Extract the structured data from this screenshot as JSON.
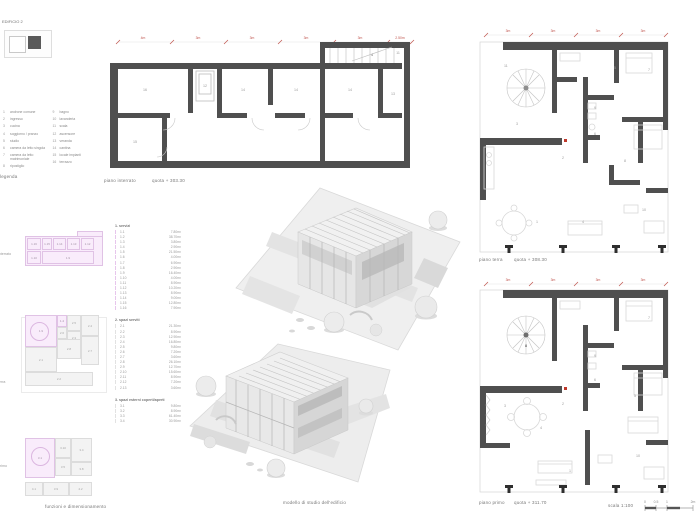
{
  "header": {
    "project_label": "EDIFICIO 2"
  },
  "legend": {
    "title": "legenda",
    "columns": [
      [
        {
          "n": "1",
          "label": "androne comune"
        },
        {
          "n": "2",
          "label": "ingresso"
        },
        {
          "n": "3",
          "label": "cucina"
        },
        {
          "n": "4",
          "label": "soggiorno / pranzo"
        },
        {
          "n": "5",
          "label": "studio"
        },
        {
          "n": "6",
          "label": "camera da letto singola"
        },
        {
          "n": "7",
          "label": "camera da letto matrimoniale"
        },
        {
          "n": "8",
          "label": "ripostiglio"
        }
      ],
      [
        {
          "n": "9",
          "label": "bagno"
        },
        {
          "n": "10",
          "label": "lavanderia"
        },
        {
          "n": "11",
          "label": "scala"
        },
        {
          "n": "12",
          "label": "ascensore"
        },
        {
          "n": "13",
          "label": "veranda"
        },
        {
          "n": "14",
          "label": "cantina"
        },
        {
          "n": "15",
          "label": "locale impianti"
        },
        {
          "n": "16",
          "label": "terrazzo"
        }
      ]
    ]
  },
  "plans": {
    "interrato": {
      "caption": "piano interrato",
      "quota": "quota + 303.30",
      "dims": [
        "4m",
        "3m",
        "3m",
        "3m",
        "3m",
        "2.50m"
      ],
      "rooms": [
        "16",
        "12",
        "14",
        "14",
        "14",
        "13",
        "15",
        "11",
        "4"
      ]
    },
    "terra": {
      "caption": "piano terra",
      "quota": "quota + 308.30",
      "dims": [
        "3m",
        "3m",
        "3m",
        "3m"
      ],
      "rooms": [
        "11",
        "5",
        "7",
        "9",
        "6",
        "3",
        "2",
        "8",
        "1",
        "4",
        "10"
      ]
    },
    "primo": {
      "caption": "piano primo",
      "quota": "quota + 311.70",
      "dims": [
        "3m",
        "3m",
        "3m",
        "3m"
      ],
      "rooms": [
        "8",
        "7",
        "5",
        "9",
        "6",
        "3",
        "2",
        "4",
        "1",
        "10"
      ]
    }
  },
  "model": {
    "caption": "modello di studio dell'edificio"
  },
  "schematics": {
    "interrato": {
      "side_label": "p. interrato",
      "cells": [
        "1.16",
        "1.15",
        "1.14",
        "1.13",
        "1.12",
        "1.10",
        "1.9"
      ]
    },
    "terra": {
      "side_label": "p. terra",
      "cells": [
        "1.9",
        "1.4",
        "2.5",
        "2.4",
        "2.6",
        "2.3",
        "2.1",
        "2.8",
        "2.7",
        "2.2"
      ]
    },
    "primo": {
      "side_label": "p. primo",
      "cells": [
        "3.1",
        "3.10",
        "3.4",
        "3.5",
        "3.8",
        "4.1",
        "3.9",
        "4.2"
      ]
    }
  },
  "area_table": {
    "sections": [
      {
        "title": "1. servizi",
        "rows": [
          {
            "code": "1.1",
            "val": "7.80m²"
          },
          {
            "code": "1.2",
            "val": "38.70m²"
          },
          {
            "code": "1.3",
            "val": "3.80m²"
          },
          {
            "code": "1.4",
            "val": "2.90m²"
          },
          {
            "code": "1.5",
            "val": "21.50m²"
          },
          {
            "code": "1.6",
            "val": "4.00m²"
          },
          {
            "code": "1.7",
            "val": "6.90m²"
          },
          {
            "code": "1.8",
            "val": "2.90m²"
          },
          {
            "code": "1.9",
            "val": "16.40m²"
          },
          {
            "code": "1.10",
            "val": "4.00m²"
          },
          {
            "code": "1.11",
            "val": "8.90m²"
          },
          {
            "code": "1.12",
            "val": "10.20m²"
          },
          {
            "code": "1.13",
            "val": "8.90m²"
          },
          {
            "code": "1.14",
            "val": "9.00m²"
          },
          {
            "code": "1.15",
            "val": "12.80m²"
          },
          {
            "code": "1.16",
            "val": "7.90m²"
          }
        ]
      },
      {
        "title": "2. spazi serviti",
        "rows": [
          {
            "code": "2.1",
            "val": "21.30m²"
          },
          {
            "code": "2.2",
            "val": "8.90m²"
          },
          {
            "code": "2.3",
            "val": "12.90m²"
          },
          {
            "code": "2.4",
            "val": "16.80m²"
          },
          {
            "code": "2.5",
            "val": "9.80m²"
          },
          {
            "code": "2.6",
            "val": "7.20m²"
          },
          {
            "code": "2.7",
            "val": "3.60m²"
          },
          {
            "code": "2.8",
            "val": "26.10m²"
          },
          {
            "code": "2.9",
            "val": "12.70m²"
          },
          {
            "code": "2.10",
            "val": "15.60m²"
          },
          {
            "code": "2.11",
            "val": "8.90m²"
          },
          {
            "code": "2.12",
            "val": "7.20m²"
          },
          {
            "code": "2.13",
            "val": "3.60m²"
          }
        ]
      },
      {
        "title": "3. spazi esterni coperti/aperti",
        "rows": [
          {
            "code": "3.1",
            "val": "9.80m²"
          },
          {
            "code": "3.2",
            "val": "8.90m²"
          },
          {
            "code": "3.3",
            "val": "61.40m²"
          },
          {
            "code": "3.4",
            "val": "30.90m²"
          }
        ]
      }
    ]
  },
  "footer": {
    "caption_left": "funzioni e dimensionamento",
    "scale_label": "scala 1:100",
    "scale_ticks": [
      "0",
      "0.5",
      "1",
      "2m"
    ]
  }
}
